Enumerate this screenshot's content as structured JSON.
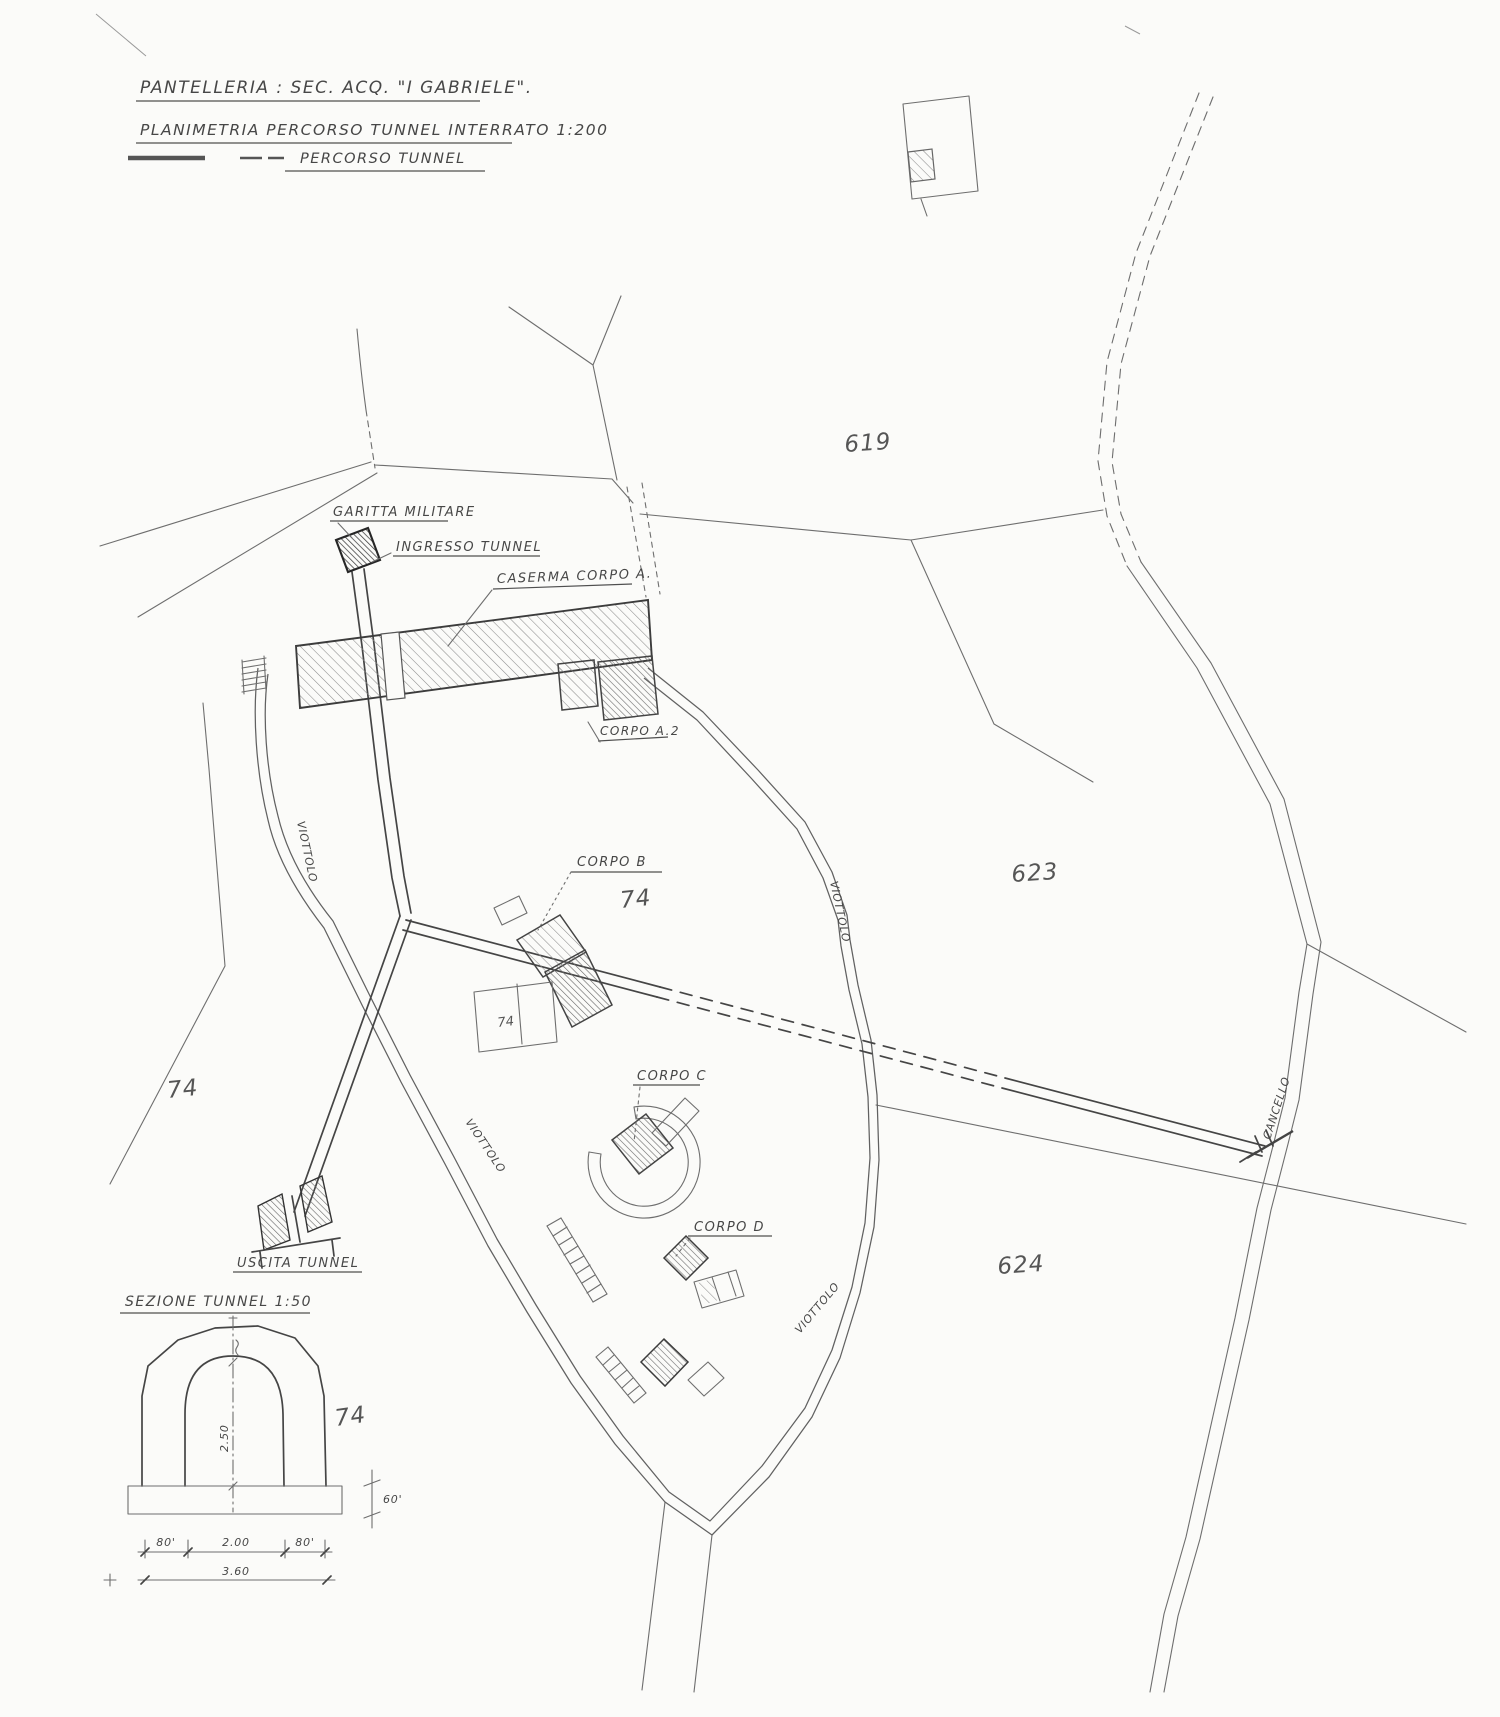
{
  "title_block": {
    "line1": "PANTELLERIA : SEC. ACQ. \"I GABRIELE\".",
    "line2": "PLANIMETRIA PERCORSO TUNNEL INTERRATO 1:200",
    "legend_label": "PERCORSO TUNNEL"
  },
  "plan_labels": {
    "garitta_militare": "GARITTA MILITARE",
    "ingresso_tunnel": "INGRESSO TUNNEL",
    "caserma_corpo_a": "CASERMA CORPO A.",
    "corpo_a2": "CORPO A.2",
    "corpo_b": "CORPO B",
    "corpo_c": "CORPO C",
    "corpo_d": "CORPO D",
    "uscita_tunnel": "USCITA TUNNEL",
    "cancello": "CANCELLO",
    "viottolo": "VIOTTOLO"
  },
  "parcel_numbers": {
    "n619": "619",
    "n623": "623",
    "n624": "624",
    "n74_west": "74",
    "n74_corpo_b": "74",
    "n74_court": "74",
    "n74_section": "74"
  },
  "section": {
    "title": "SEZIONE TUNNEL 1:50",
    "height_dim": "2.50",
    "width_left": "80'",
    "width_center": "2.00",
    "width_right": "80'",
    "width_total": "3.60",
    "base_height": "60'"
  },
  "style": {
    "paper_color": "#fbfbf9",
    "ink_color": "#474747"
  }
}
